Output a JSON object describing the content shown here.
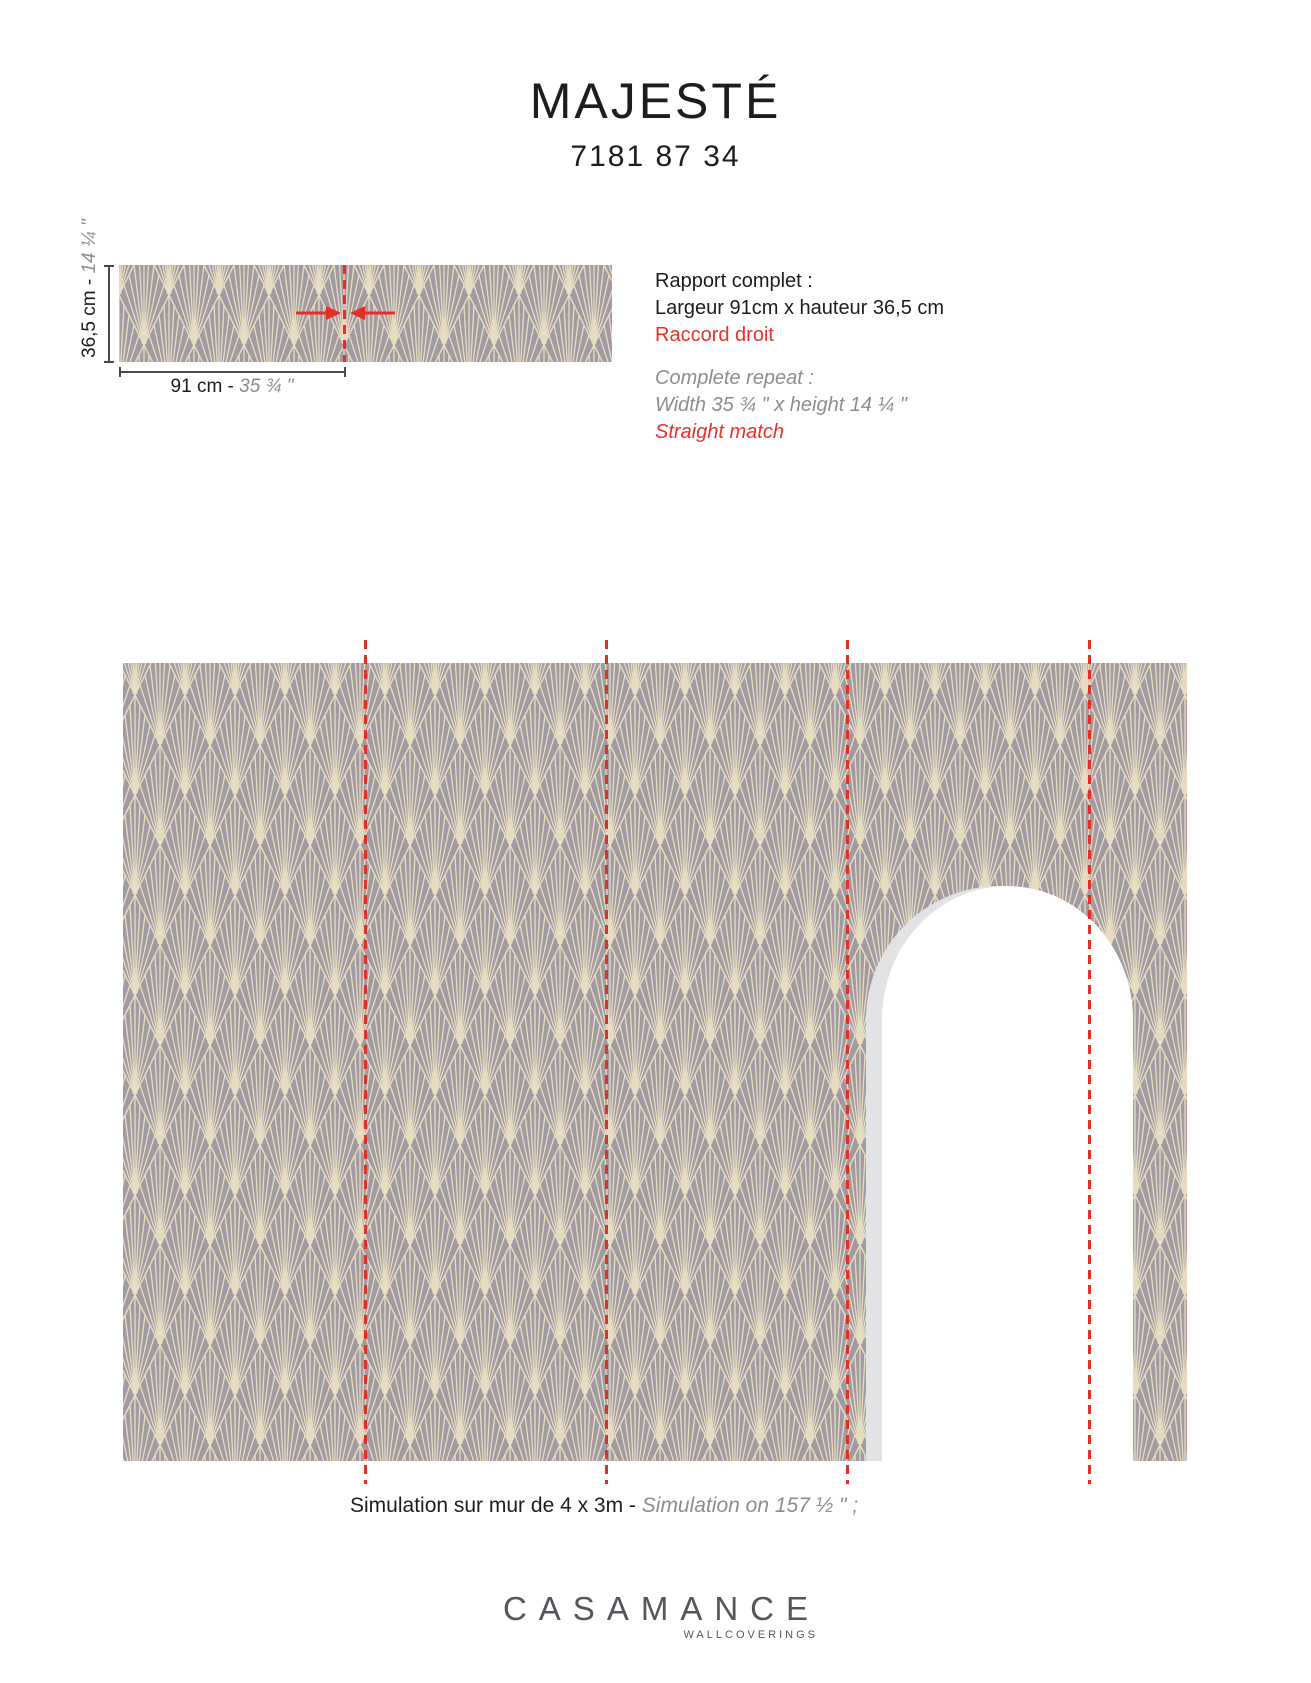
{
  "title": "MAJESTÉ",
  "reference": "7181 87 34",
  "repeat": {
    "height_label_metric": "36,5 cm - ",
    "height_label_imperial": "14 ¼ \"",
    "width_label_metric": "91 cm - ",
    "width_label_imperial": "35 ¾ \"",
    "fr": {
      "line1": "Rapport complet :",
      "line2": "Largeur 91cm x hauteur 36,5 cm",
      "line3": "Raccord droit"
    },
    "en": {
      "line1": "Complete repeat :",
      "line2": "Width 35 ¾ \" x height 14 ¼ \"",
      "line3": "Straight match"
    }
  },
  "simulation": {
    "caption_fr": "Simulation sur mur de 4 x 3m - ",
    "caption_en": "Simulation on 157 ½ \" ;"
  },
  "logo": {
    "name": "CASAMANCE",
    "subtitle": "WALLCOVERINGS"
  },
  "colors": {
    "wallpaper_background": "#a19aa1",
    "pattern_line": "#e7dcc1",
    "accent_red": "#e62e24",
    "text_black": "#1d1d1b",
    "text_gray": "#8d8d8d",
    "logo_gray": "#54565b",
    "arch_shadow": "#e3e3e6"
  }
}
